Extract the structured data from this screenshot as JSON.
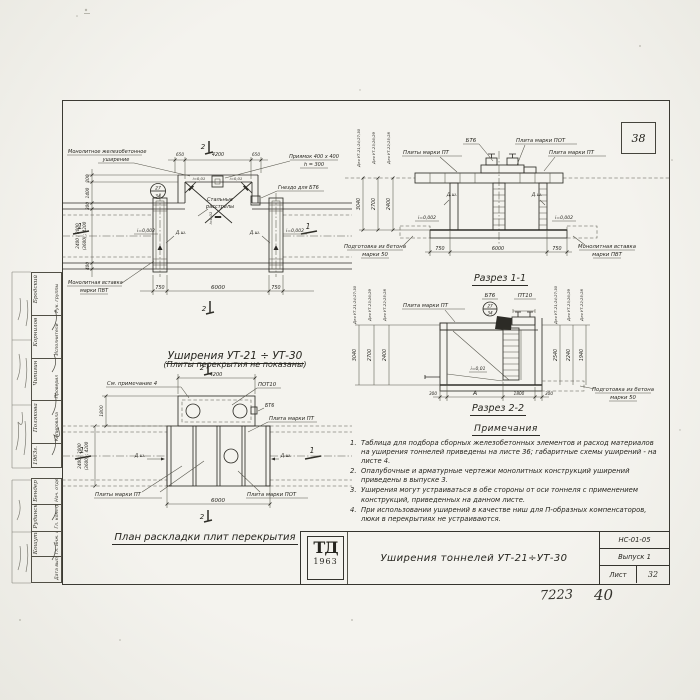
{
  "page": {
    "badge": "38",
    "footer_code": "7223",
    "footer_page": "40"
  },
  "stamp_upper": {
    "cells": [
      {
        "role": "Рук. группы",
        "name": "Бродский"
      },
      {
        "role": "Исполнители",
        "name": "Корнилов"
      },
      {
        "role": "Проверил",
        "name": "Чипигин"
      },
      {
        "role": "Копировала",
        "name": "Полякова"
      },
      {
        "role": "",
        "name": "1963г."
      }
    ]
  },
  "stamp_lower": {
    "cells": [
      {
        "role": "Нач. отдела",
        "name": "Бендер"
      },
      {
        "role": "Гл. конструктор",
        "name": "Рудинский"
      },
      {
        "role": "Гл. инж. пр.",
        "name": "Кошутин"
      },
      {
        "role": "Дата выпуска",
        "name": ""
      }
    ]
  },
  "plan_top": {
    "title": "Уширения УТ-21 ÷ УТ-30",
    "subtitle": "(Плиты перекрытия не показаны)",
    "callout_widening_1": "Монолитное железобетонное",
    "callout_widening_2": "уширение",
    "callout_pit_1": "Приямок 400 х 400",
    "callout_pit_2": "h = 300",
    "callout_socket": "Гнездо для БТ6",
    "callout_insert_1": "Монолитная вставка",
    "callout_insert_2": "марки ПВТ",
    "label_struts_1": "Стальные",
    "label_struts_2": "расстрелы",
    "slope_left": "i=0,002",
    "slope_right": "i=0,002",
    "slope_inner_left": "i=0,01",
    "slope_inner_right": "i=0,01",
    "slope_center": "i=0,01",
    "joint_left": "Д.ш.",
    "joint_right": "Д.ш.",
    "detail_top": "27",
    "detail_bottom": "34",
    "dim_top": [
      "650",
      "4200",
      "650"
    ],
    "dim_bottom": [
      "750",
      "6000",
      "750"
    ],
    "dim_left": [
      "200",
      "1400",
      "300",
      "400"
    ],
    "dim_tunnel_1": "2400 ; 3000",
    "dim_tunnel_2": "(3600) ; 4200",
    "mark_top": "2",
    "mark_bottom": "2",
    "mark_left": "1",
    "mark_right": "1"
  },
  "section1": {
    "title": "Разрез 1-1",
    "label_bt6": "БТ6",
    "label_pot": "Плита марки ПОТ",
    "label_pt_left": "Плиты марки ПТ",
    "label_pt_right": "Плита марки ПТ",
    "joint_left": "Д.ш.",
    "joint_right": "Д.ш.",
    "slope_left": "i=0,002",
    "slope_right": "i=0,002",
    "callout_prep_1": "Подготовка из бетона",
    "callout_prep_2": "марки 50",
    "callout_insert_1": "Монолитная вставка",
    "callout_insert_2": "марки ПВТ",
    "dim_bottom": [
      "750",
      "6000",
      "750"
    ],
    "rows": [
      {
        "caption": "Для УТ-21;24;27;30",
        "value": "3040"
      },
      {
        "caption": "Для УТ-23;26;29",
        "value": "2700"
      },
      {
        "caption": "Для УТ-22;25;28",
        "value": "2400"
      }
    ]
  },
  "section2": {
    "title": "Разрез 2-2",
    "label_pt": "Плита марки ПТ",
    "label_bt6": "БТ6",
    "label_pt10": "ПТ10",
    "detail_top": "27",
    "detail_bottom": "34",
    "slope": "i=0,01",
    "callout_prep_1": "Подготовка из бетона",
    "callout_prep_2": "марки 50",
    "dims": [
      "300",
      "А",
      "1800",
      "300"
    ],
    "rows_left": [
      {
        "caption": "Для УТ-21;24;27;30",
        "value": "3040"
      },
      {
        "caption": "Для УТ-23;26;29",
        "value": "2700"
      },
      {
        "caption": "Для УТ-22;25;28",
        "value": "2400"
      }
    ],
    "rows_right": [
      {
        "caption": "Для УТ-21;24;27;30",
        "value": "2540"
      },
      {
        "caption": "Для УТ-23;26;29",
        "value": "2240"
      },
      {
        "caption": "Для УТ-22;25;28",
        "value": "1940"
      }
    ]
  },
  "plan_bottom": {
    "title": "План раскладки плит перекрытия",
    "callout_note": "См. примечание 4",
    "label_pot10": "ПОТ10",
    "label_bt6": "БТ6",
    "label_pt": "Плита марки ПТ",
    "label_pt_plural": "Плиты марки ПТ",
    "label_pot": "Плита марки ПОТ",
    "joint_left": "Д.ш.",
    "joint_right": "Д.ш.",
    "dim_top": "4200",
    "dim_bottom": "6000",
    "dim_side": "1800",
    "dim_tunnel_1": "2400 ; 3000",
    "dim_tunnel_2": "(3600) ; 4200",
    "mark_top": "2",
    "mark_bottom": "2",
    "mark_left": "1",
    "mark_right": "1"
  },
  "notes": {
    "title": "Примечания",
    "items": [
      {
        "num": "1.",
        "text": "Таблица для подбора сборных железобетонных элементов и расход материалов на уширения тоннелей приведены на листе 36; габаритные схемы уширений - на листе 4."
      },
      {
        "num": "2.",
        "text": "Опалубочные и арматурные чертежи монолитных конструкций уширений приведены в выпуске 3."
      },
      {
        "num": "3.",
        "text": "Уширения могут устраиваться в обе стороны от оси тоннеля с применением конструкций, приведенных на данном листе."
      },
      {
        "num": "4.",
        "text": "При использовании уширений в качестве ниш для П-образных компенсаторов, люки в перекрытиях не устраиваются."
      }
    ]
  },
  "titleblock": {
    "logo_top": "ТД",
    "logo_year": "1963",
    "title": "Уширения тоннелей УТ-21÷УТ-30",
    "code": "НС-01-05",
    "issue": "Выпуск 1",
    "sheet_label": "Лист",
    "sheet_no": "32"
  }
}
